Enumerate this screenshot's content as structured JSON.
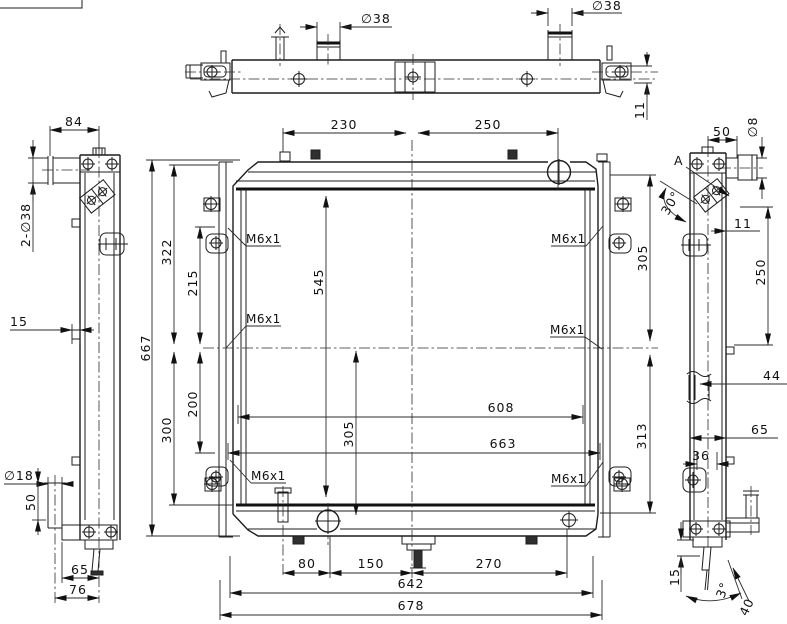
{
  "views": {
    "top": {
      "dim_pipe1": "∅38",
      "dim_pipe2": "∅38",
      "dim_bracket": "11"
    },
    "left": {
      "dim_pipe_len": "84",
      "dim_pipes": "2-∅38",
      "dim_tab": "15",
      "dim_outlet_dia": "∅18",
      "dim_outlet_len": "50",
      "dim_foot_inner": "65",
      "dim_foot_outer": "76"
    },
    "front": {
      "dim_top_left": "230",
      "dim_top_right": "250",
      "dim_left_upper": "322",
      "dim_left_hole_upper": "215",
      "dim_core_height": "545",
      "dim_core_lower": "305",
      "dim_left_lower": "300",
      "dim_left_hole_lower": "200",
      "dim_overall_height": "667",
      "dim_core_width": "608",
      "dim_mount_width": "663",
      "dim_right_upper": "305",
      "dim_right_lower": "313",
      "dim_bottom_a": "80",
      "dim_bottom_b": "150",
      "dim_bottom_c": "270",
      "dim_mount_span": "642",
      "dim_overall_width": "678",
      "thread": "M6x1"
    },
    "right": {
      "dim_pipe_offset": "50",
      "dim_pipe_dia": "∅8",
      "view_label": "A",
      "dim_angle": "30°",
      "dim_gap": "11",
      "dim_upper": "250",
      "dim_bracket": "44",
      "dim_depth": "65",
      "dim_inner": "36",
      "dim_plate": "15",
      "dim_tilt": "3°",
      "dim_stud": "40"
    }
  }
}
